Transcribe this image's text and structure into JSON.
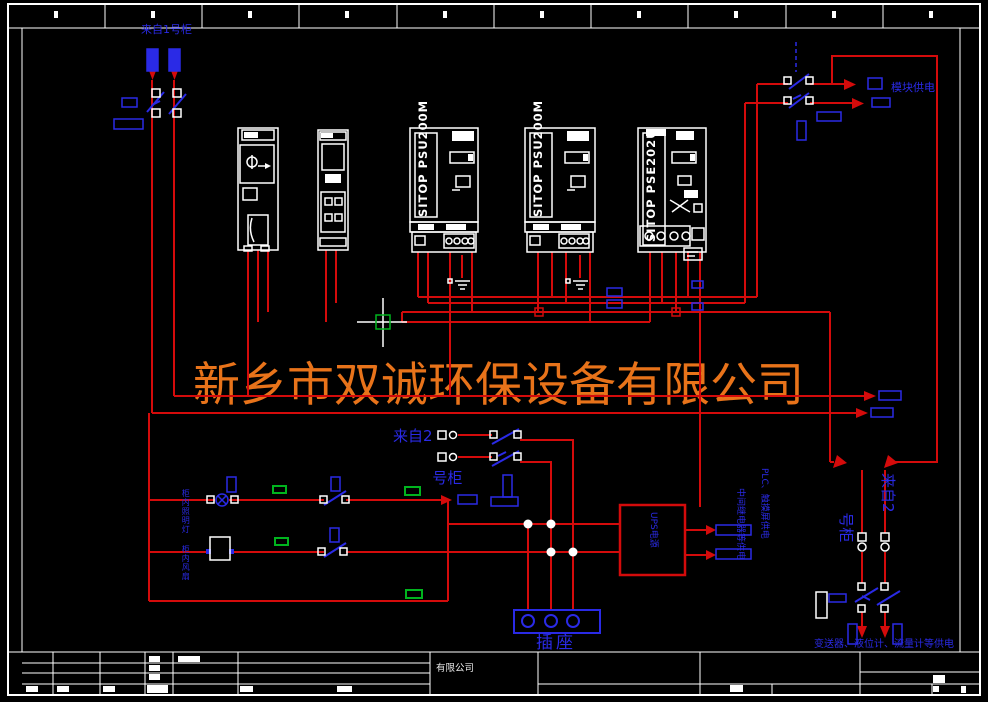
{
  "palette": {
    "background": "#000000",
    "wire_red": "#d40b0b",
    "symbol_blue": "#2a2ae6",
    "label_green": "#00b41e",
    "line_white": "#ffffff",
    "watermark_orange": "#e8731a"
  },
  "watermark": {
    "text": "新乡市双诚环保设备有限公司"
  },
  "labels": {
    "from_cabinet1": "来自1号柜",
    "from_cabinet2_l1": "来自2",
    "from_cabinet2_l2": "号柜",
    "module_power": "模块供电",
    "socket": "插座",
    "transmitter_power": "变送器、液位计、流量计等供电",
    "cabinet_light": "柜内照明灯",
    "cabinet_fan": "柜内风扇",
    "ups_box": "UPS电源",
    "plc_power": "PLC、触摸屏供电",
    "relay_power": "中间继电器等供电",
    "company": "有限公司"
  },
  "devices": {
    "psu1": "SITOP PSU200M",
    "psu2": "SITOP PSU200M",
    "psu3": "SITOP PSE202U"
  },
  "ruler": {
    "segments": 10
  },
  "cursor": {
    "type": "crosshair-with-pickbox"
  }
}
